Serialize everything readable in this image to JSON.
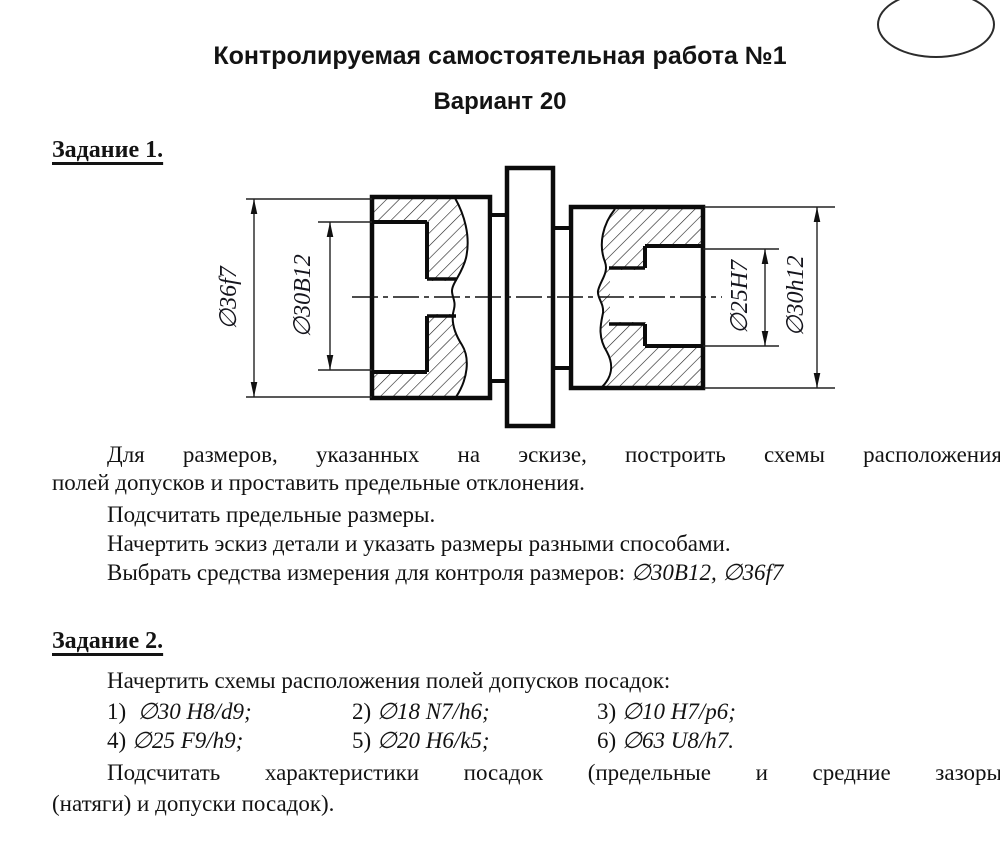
{
  "page": {
    "title": "Контролируемая самостоятельная работа №1",
    "subtitle": "Вариант 20"
  },
  "task1": {
    "heading": "Задание 1.",
    "para1_line1": "Для размеров, указанных на эскизе, построить схемы расположения",
    "para1_line2": "полей допусков и проставить предельные отклонения.",
    "para2": "Подсчитать предельные размеры.",
    "para3": "Начертить эскиз детали и указать размеры разными способами.",
    "para4_prefix": "Выбрать средства измерения для контроля размеров: ",
    "para4_sizes": "∅30B12, ∅36f7"
  },
  "drawing": {
    "dims": {
      "left_outer": "∅36f7",
      "left_bore": "∅30B12",
      "right_bore": "∅25H7",
      "right_outer": "∅30h12"
    }
  },
  "task2": {
    "heading": "Задание 2.",
    "intro": "Начертить схемы расположения полей допусков посадок:",
    "fits": [
      {
        "num": "1)",
        "value": "∅30 H8/d9;"
      },
      {
        "num": "2)",
        "value": "∅18 N7/h6;"
      },
      {
        "num": "3)",
        "value": "∅10 H7/p6;"
      },
      {
        "num": "4)",
        "value": "∅25 F9/h9;"
      },
      {
        "num": "5)",
        "value": "∅20 H6/k5;"
      },
      {
        "num": "6)",
        "value": "∅63 U8/h7."
      }
    ],
    "outro_line1": "Подсчитать характеристики посадок (предельные и средние зазоры",
    "outro_line2": "(натяги) и допуски посадок)."
  }
}
